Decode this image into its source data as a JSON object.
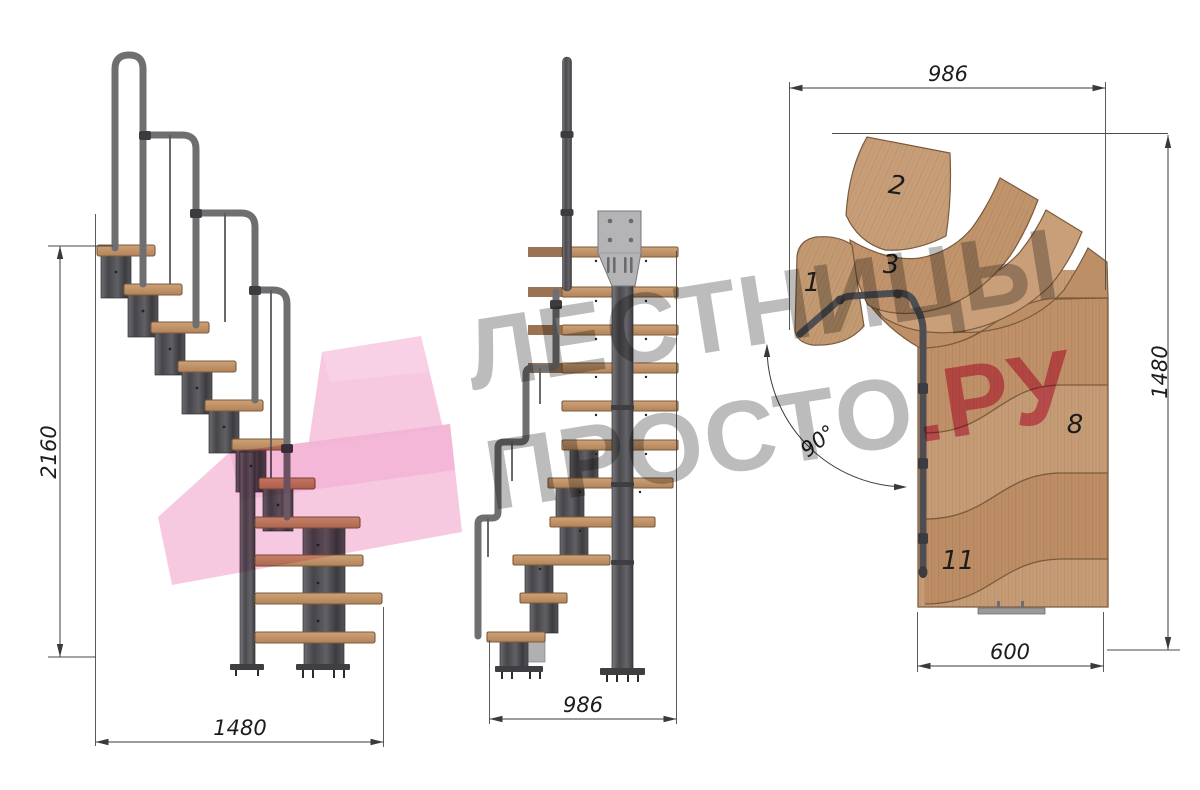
{
  "watermark": {
    "line1": "ЛЕСТНИЦЫ",
    "line2_main": "ПРОСТО",
    "line2_accent": ".РУ",
    "gray_color": "#bcbcbc",
    "accent_color": "#ec7ba0",
    "ribbon_color": "#f6c3de"
  },
  "side_view": {
    "name": "side-elevation",
    "dim_total_height": "2160",
    "dim_total_depth": "1480"
  },
  "front_view": {
    "name": "front-elevation",
    "dim_total_width": "986"
  },
  "plan_view": {
    "name": "top-plan",
    "dim_fan_width": "986",
    "dim_total_length": "1480",
    "dim_flight_width": "600",
    "dim_turn_angle": "90°",
    "step_labels": [
      "1",
      "2",
      "3",
      "8",
      "11"
    ]
  },
  "colors": {
    "wood": "#c79e78",
    "wood_dark_edge": "#7b5b3c",
    "metal_module": "#4a4a4e",
    "metal_rail": "#6f6f72",
    "mount_plate": "#b4b4b6",
    "dimension_lines": "#3a3a3a",
    "background": "#ffffff"
  }
}
